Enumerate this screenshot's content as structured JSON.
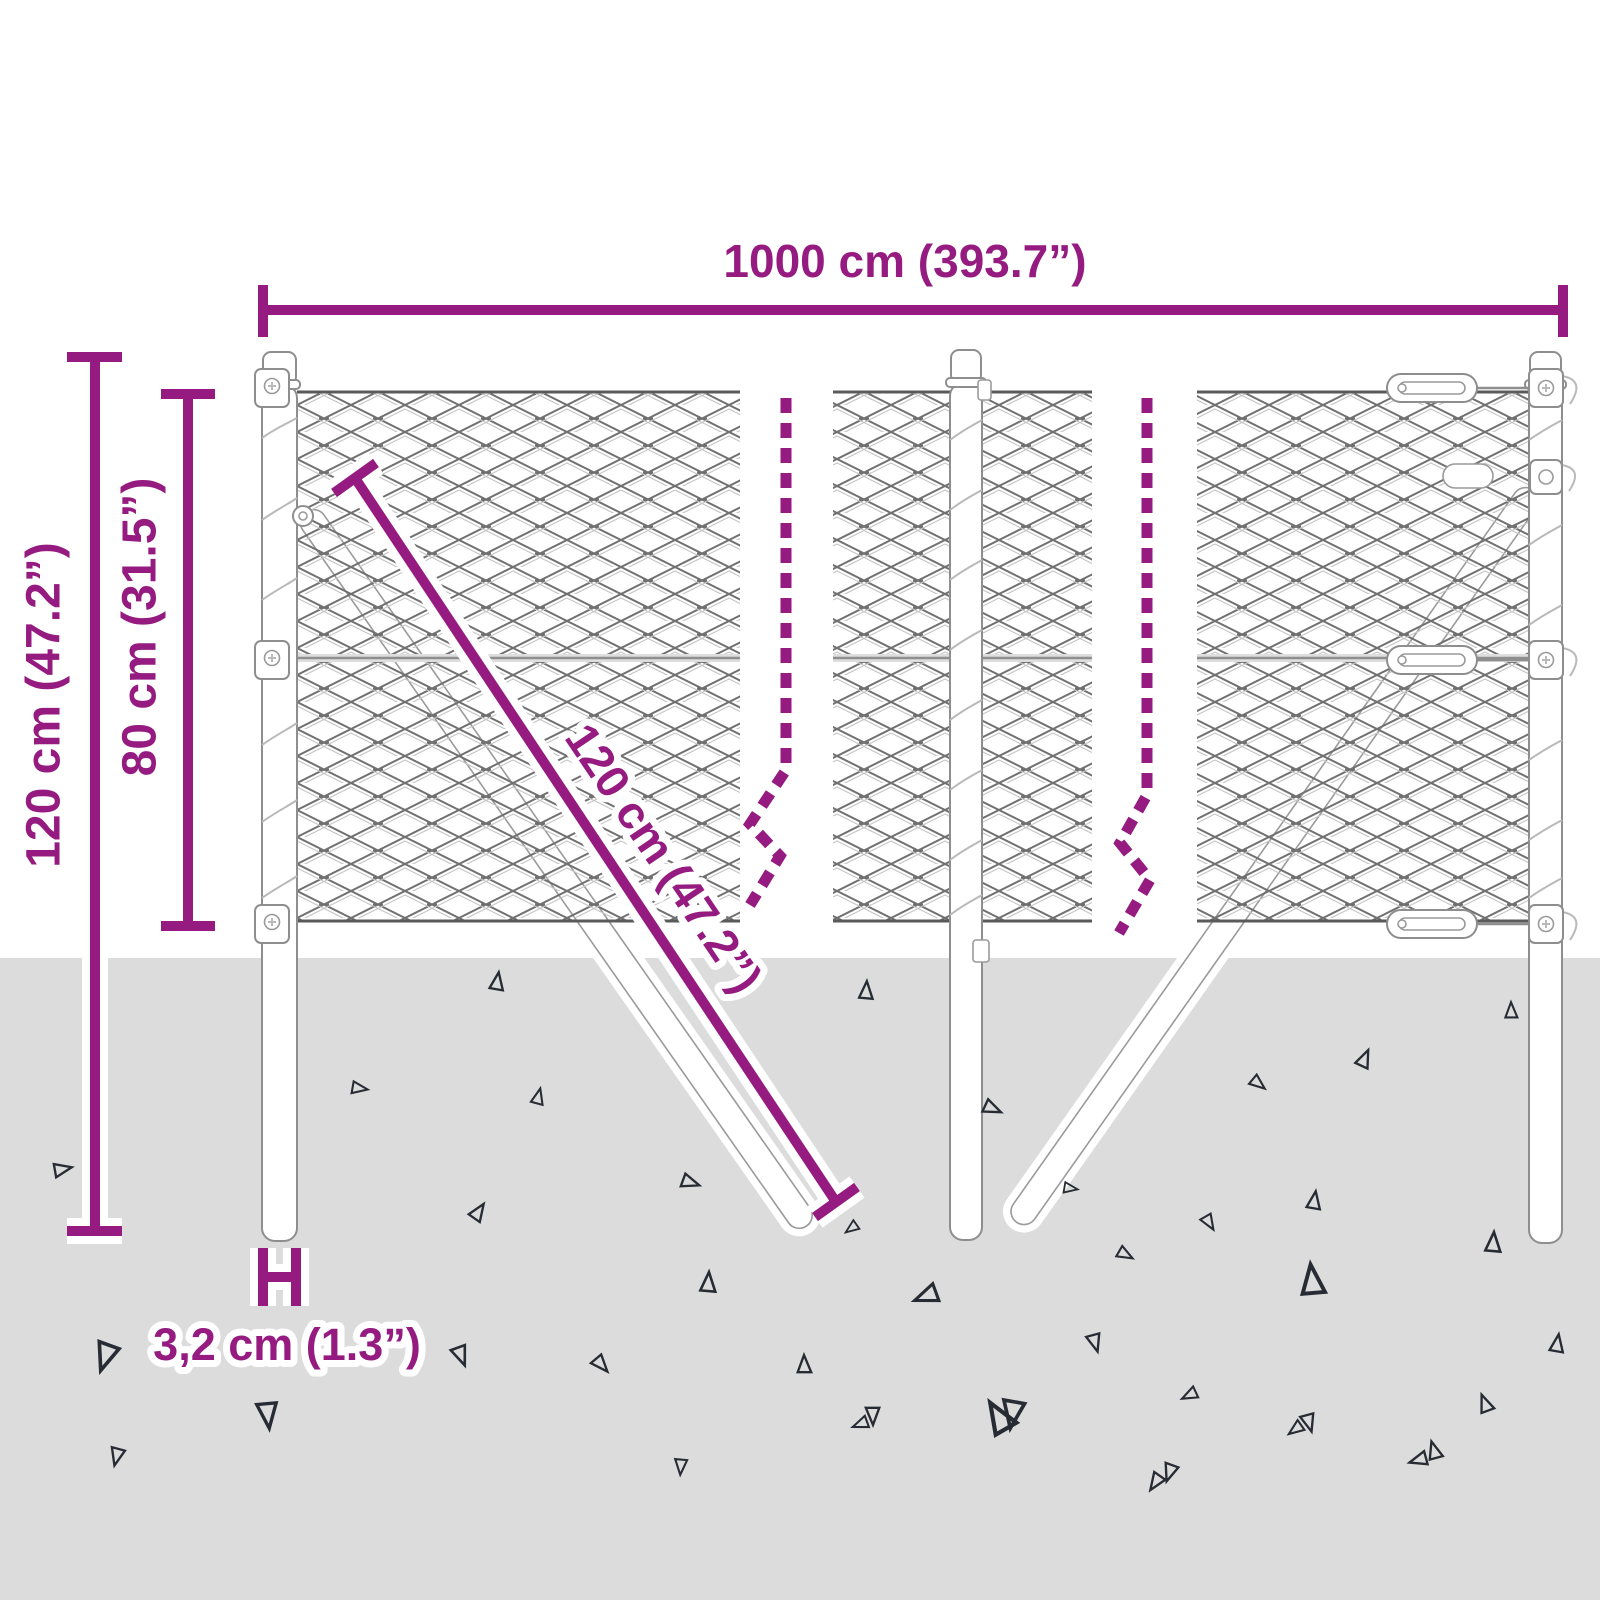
{
  "diagram_title": "chain-link fence dimension diagram",
  "colors": {
    "accent_purple": "#951B81",
    "ground_gray": "#dcdcdc",
    "mesh_gray": "#707070",
    "metal_outline": "#8e8e8e",
    "triangle_outline": "#272b33",
    "background": "#ffffff"
  },
  "labels": {
    "total_width": "1000 cm (393.7”)",
    "post_total_height": "120 cm (47.2”)",
    "mesh_height": "80 cm (31.5”)",
    "brace_length": "120 cm (47.2”)",
    "post_diameter": "3,2 cm (1.3”)"
  },
  "ground": {
    "triangles": [
      {
        "x": 497,
        "y": 982,
        "r": 10,
        "s": 0.9
      },
      {
        "x": 866,
        "y": 991,
        "r": 5,
        "s": 0.9
      },
      {
        "x": 1511,
        "y": 1011,
        "r": 0,
        "s": 0.8
      },
      {
        "x": 359,
        "y": 1088,
        "r": 100,
        "s": 0.8
      },
      {
        "x": 538,
        "y": 1097,
        "r": 15,
        "s": 0.8
      },
      {
        "x": 1364,
        "y": 1059,
        "r": 25,
        "s": 0.9
      },
      {
        "x": 1258,
        "y": 1083,
        "r": 130,
        "s": 0.8
      },
      {
        "x": 62,
        "y": 1169,
        "r": 80,
        "s": 0.9
      },
      {
        "x": 690,
        "y": 1182,
        "r": 110,
        "s": 0.9
      },
      {
        "x": 478,
        "y": 1212,
        "r": 35,
        "s": 0.9
      },
      {
        "x": 992,
        "y": 1108,
        "r": 115,
        "s": 0.9
      },
      {
        "x": 1314,
        "y": 1201,
        "r": 10,
        "s": 0.9
      },
      {
        "x": 1209,
        "y": 1222,
        "r": 150,
        "s": 0.8
      },
      {
        "x": 1493,
        "y": 1243,
        "r": 5,
        "s": 1.0
      },
      {
        "x": 1125,
        "y": 1254,
        "r": 120,
        "s": 0.8
      },
      {
        "x": 708,
        "y": 1283,
        "r": 5,
        "s": 1.0
      },
      {
        "x": 927,
        "y": 1296,
        "r": 250,
        "s": 1.2
      },
      {
        "x": 1312,
        "y": 1281,
        "r": 355,
        "s": 1.5
      },
      {
        "x": 106,
        "y": 1356,
        "r": 200,
        "s": 1.4
      },
      {
        "x": 461,
        "y": 1355,
        "r": 160,
        "s": 1.0
      },
      {
        "x": 601,
        "y": 1364,
        "r": 140,
        "s": 0.9
      },
      {
        "x": 1095,
        "y": 1342,
        "r": 165,
        "s": 0.9
      },
      {
        "x": 1557,
        "y": 1344,
        "r": 10,
        "s": 0.9
      },
      {
        "x": 804,
        "y": 1365,
        "r": 0,
        "s": 0.9
      },
      {
        "x": 1190,
        "y": 1395,
        "r": 245,
        "s": 0.8
      },
      {
        "x": 1485,
        "y": 1404,
        "r": 340,
        "s": 0.9
      },
      {
        "x": 861,
        "y": 1424,
        "r": 250,
        "s": 0.8
      },
      {
        "x": 999,
        "y": 1418,
        "r": 330,
        "s": 1.6
      },
      {
        "x": 1296,
        "y": 1429,
        "r": 235,
        "s": 0.8
      },
      {
        "x": 1419,
        "y": 1460,
        "r": 255,
        "s": 0.9
      },
      {
        "x": 1156,
        "y": 1482,
        "r": 215,
        "s": 0.9
      },
      {
        "x": 268,
        "y": 1414,
        "r": 175,
        "s": 1.3
      },
      {
        "x": 117,
        "y": 1456,
        "r": 195,
        "s": 0.9
      },
      {
        "x": 681,
        "y": 1466,
        "r": 185,
        "s": 0.8
      },
      {
        "x": 1309,
        "y": 1422,
        "r": 165,
        "s": 0.9
      },
      {
        "x": 873,
        "y": 1415,
        "r": 180,
        "s": 0.9
      },
      {
        "x": 1013,
        "y": 1413,
        "r": 190,
        "s": 1.4
      },
      {
        "x": 1170,
        "y": 1472,
        "r": 200,
        "s": 0.9
      },
      {
        "x": 1434,
        "y": 1451,
        "r": 345,
        "s": 0.9
      },
      {
        "x": 852,
        "y": 1228,
        "r": 235,
        "s": 0.7
      },
      {
        "x": 1070,
        "y": 1188,
        "r": 100,
        "s": 0.7
      }
    ]
  }
}
